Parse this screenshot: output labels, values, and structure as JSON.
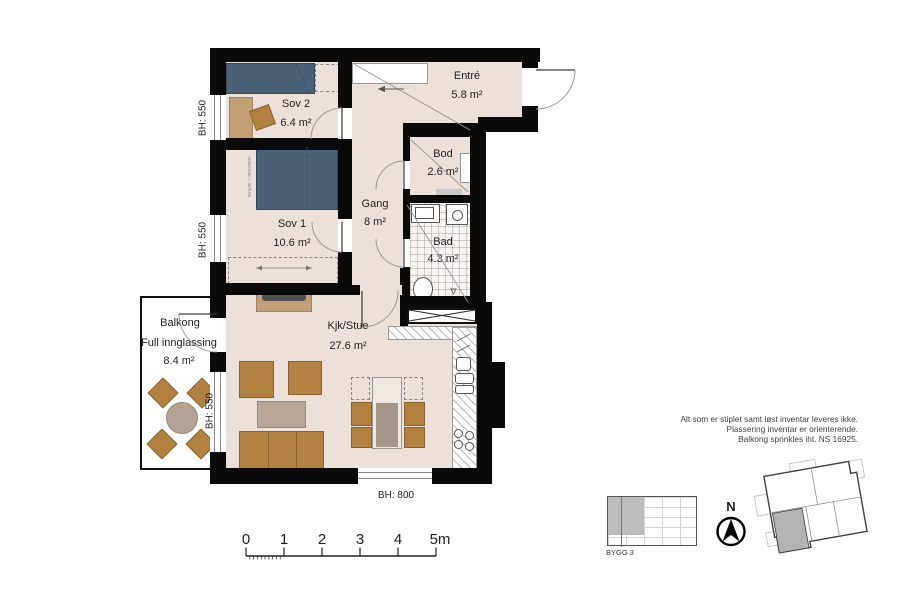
{
  "plan": {
    "rooms": [
      {
        "id": "sov2",
        "name": "Sov 2",
        "area": "6.4 m²"
      },
      {
        "id": "sov1",
        "name": "Sov 1",
        "area": "10.6 m²"
      },
      {
        "id": "entre",
        "name": "Entré",
        "area": "5.8 m²"
      },
      {
        "id": "bod",
        "name": "Bod",
        "area": "2.6 m²"
      },
      {
        "id": "gang",
        "name": "Gang",
        "area": "8 m²"
      },
      {
        "id": "bad",
        "name": "Bad",
        "area": "4.3 m²"
      },
      {
        "id": "kjk_stue",
        "name": "Kjk/Stue",
        "area": "27.6 m²"
      },
      {
        "id": "balkong",
        "name": "Balkong",
        "subtitle": "Full innglassing",
        "area": "8.4 m²"
      }
    ],
    "sill_heights": {
      "window_sov2": "BH: 550",
      "window_sov1": "BH: 550",
      "window_balkong": "BH: 550",
      "window_stue": "BH: 800"
    },
    "bed_annotation": "Seng bk. = 160x200cm"
  },
  "scale_bar": {
    "labels": [
      "0",
      "1",
      "2",
      "3",
      "4",
      "5m"
    ]
  },
  "notes": {
    "lines": [
      "Alt som er stiplet samt løst inventar leveres ikke.",
      "Plassering inventar er orienterende.",
      "Balkong sprinkles iht. NS 16925."
    ]
  },
  "key_plan": {
    "building_label": "BYGG 3"
  },
  "compass": {
    "label": "N"
  },
  "colors": {
    "wall": "#0a0a0a",
    "floor": "#ece1da",
    "bed": "#4b6177",
    "furniture_brown": "#b2813f",
    "furniture_tan": "#c2a077",
    "table_gray": "#b9a697",
    "tile_bg": "#f7f4f1",
    "site_unit_gray": "#b3b3b3"
  }
}
